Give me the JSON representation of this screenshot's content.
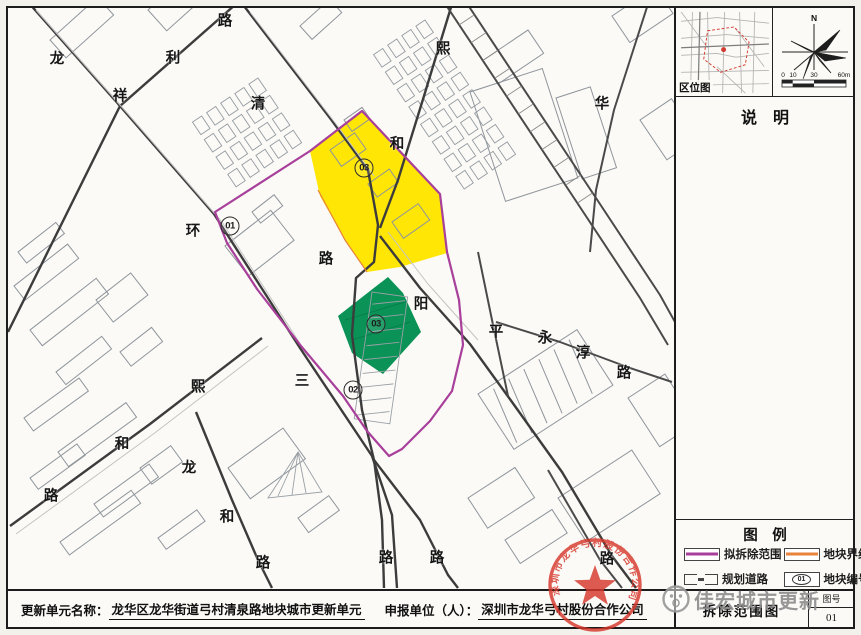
{
  "map": {
    "road_labels": [
      {
        "t": "龙",
        "x": 57,
        "y": 58
      },
      {
        "t": "祥",
        "x": 120,
        "y": 95
      },
      {
        "t": "利",
        "x": 173,
        "y": 57
      },
      {
        "t": "路",
        "x": 225,
        "y": 20
      },
      {
        "t": "清",
        "x": 258,
        "y": 103
      },
      {
        "t": "熙",
        "x": 443,
        "y": 48
      },
      {
        "t": "和",
        "x": 397,
        "y": 143
      },
      {
        "t": "华",
        "x": 602,
        "y": 103
      },
      {
        "t": "环",
        "x": 193,
        "y": 230
      },
      {
        "t": "路",
        "x": 326,
        "y": 258
      },
      {
        "t": "阳",
        "x": 421,
        "y": 303
      },
      {
        "t": "平",
        "x": 496,
        "y": 331
      },
      {
        "t": "永",
        "x": 545,
        "y": 337
      },
      {
        "t": "淳",
        "x": 583,
        "y": 352
      },
      {
        "t": "路",
        "x": 624,
        "y": 372
      },
      {
        "t": "三",
        "x": 302,
        "y": 380
      },
      {
        "t": "熙",
        "x": 198,
        "y": 386
      },
      {
        "t": "和",
        "x": 122,
        "y": 443
      },
      {
        "t": "路",
        "x": 51,
        "y": 495
      },
      {
        "t": "龙",
        "x": 189,
        "y": 467
      },
      {
        "t": "和",
        "x": 227,
        "y": 516
      },
      {
        "t": "路",
        "x": 263,
        "y": 562
      },
      {
        "t": "路",
        "x": 386,
        "y": 557
      },
      {
        "t": "路",
        "x": 437,
        "y": 557
      },
      {
        "t": "路",
        "x": 607,
        "y": 558
      }
    ],
    "plot_markers": [
      {
        "t": "01",
        "x": 230,
        "y": 226
      },
      {
        "t": "02",
        "x": 353,
        "y": 390
      },
      {
        "t": "03",
        "x": 364,
        "y": 168
      },
      {
        "t": "03",
        "x": 376,
        "y": 324
      }
    ],
    "colors": {
      "demolition_outline": "#a83f9b",
      "plot_yellow": "#ffe604",
      "plot_green": "#0a9257",
      "plot_boundary_orange": "#e8833a"
    }
  },
  "side_panel": {
    "inset_label": "区位图",
    "compass_north": "N",
    "scale_ticks": [
      "0",
      "10",
      "30",
      "60m"
    ],
    "notes_title": "说　明",
    "legend_title": "图　例",
    "legend_items": [
      {
        "label": "拟拆除范围",
        "type": "line",
        "color": "#a83f9b"
      },
      {
        "label": "地块界线",
        "type": "line",
        "color": "#e8833a"
      },
      {
        "label": "规划道路",
        "type": "road"
      },
      {
        "label": "地块编号",
        "type": "badge",
        "badge": "01"
      }
    ],
    "title_block": {
      "drawing_title": "拆除范围图",
      "sheet_no_label": "图号",
      "sheet_no": "01"
    }
  },
  "footer": {
    "name_label": "更新单元名称：",
    "name_value": "龙华区龙华街道弓村清泉路地块城市更新单元",
    "applicant_label": "申报单位（人）：",
    "applicant_value": "深圳市龙华弓村股份合作公司"
  },
  "stamp": {
    "text": "深圳市龙华弓村股份合作公司",
    "color": "#d6382c"
  },
  "watermark": {
    "text": "佳宏城市更新"
  }
}
